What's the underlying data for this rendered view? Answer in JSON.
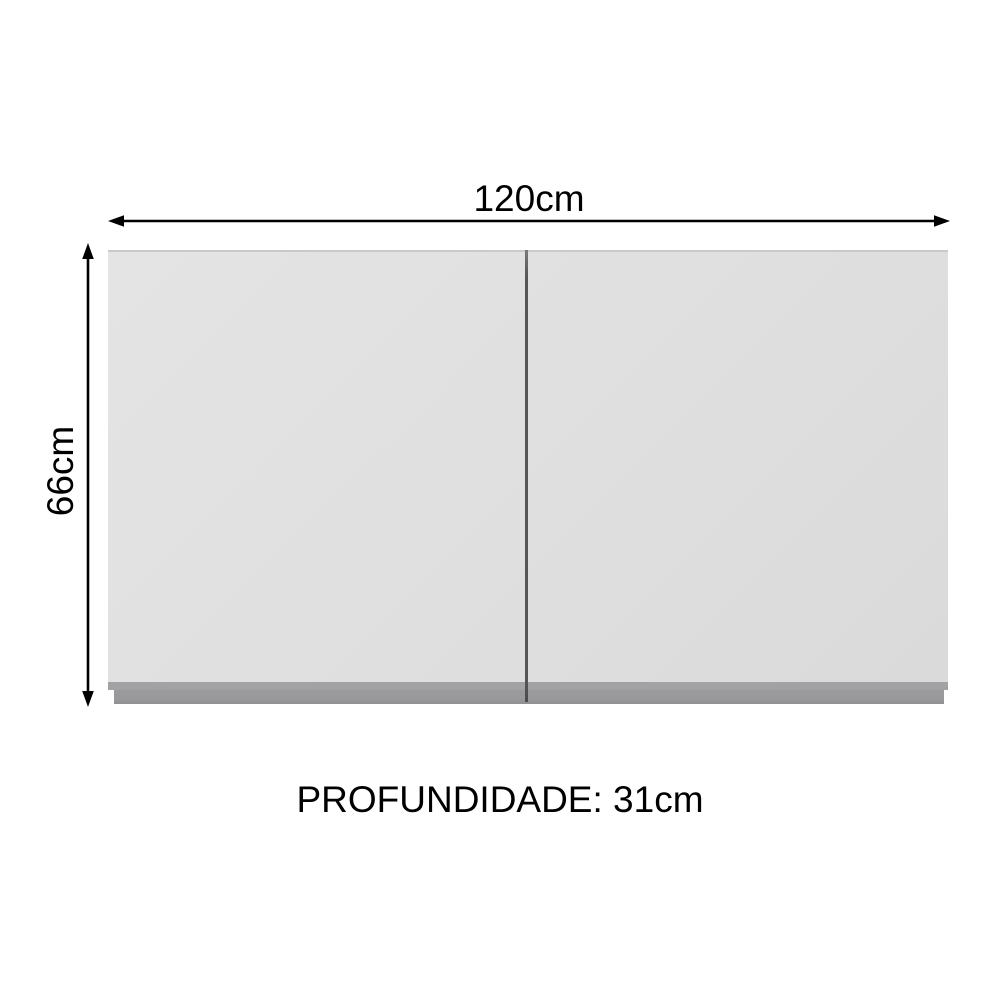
{
  "diagram": {
    "type": "furniture-dimension-diagram",
    "subject": "two-door wall cabinet front view",
    "width_label": "120cm",
    "height_label": "66cm",
    "depth_label": "PROFUNDIDADE: 31cm",
    "dimensions": {
      "width_cm": 120,
      "height_cm": 66,
      "depth_cm": 31
    },
    "colors": {
      "background": "#ffffff",
      "cabinet_body": "#dfdfdf",
      "cabinet_base": "#9a9a9d",
      "door_gap": "#565656",
      "dimension_lines": "#000000",
      "label_text": "#000000"
    }
  }
}
